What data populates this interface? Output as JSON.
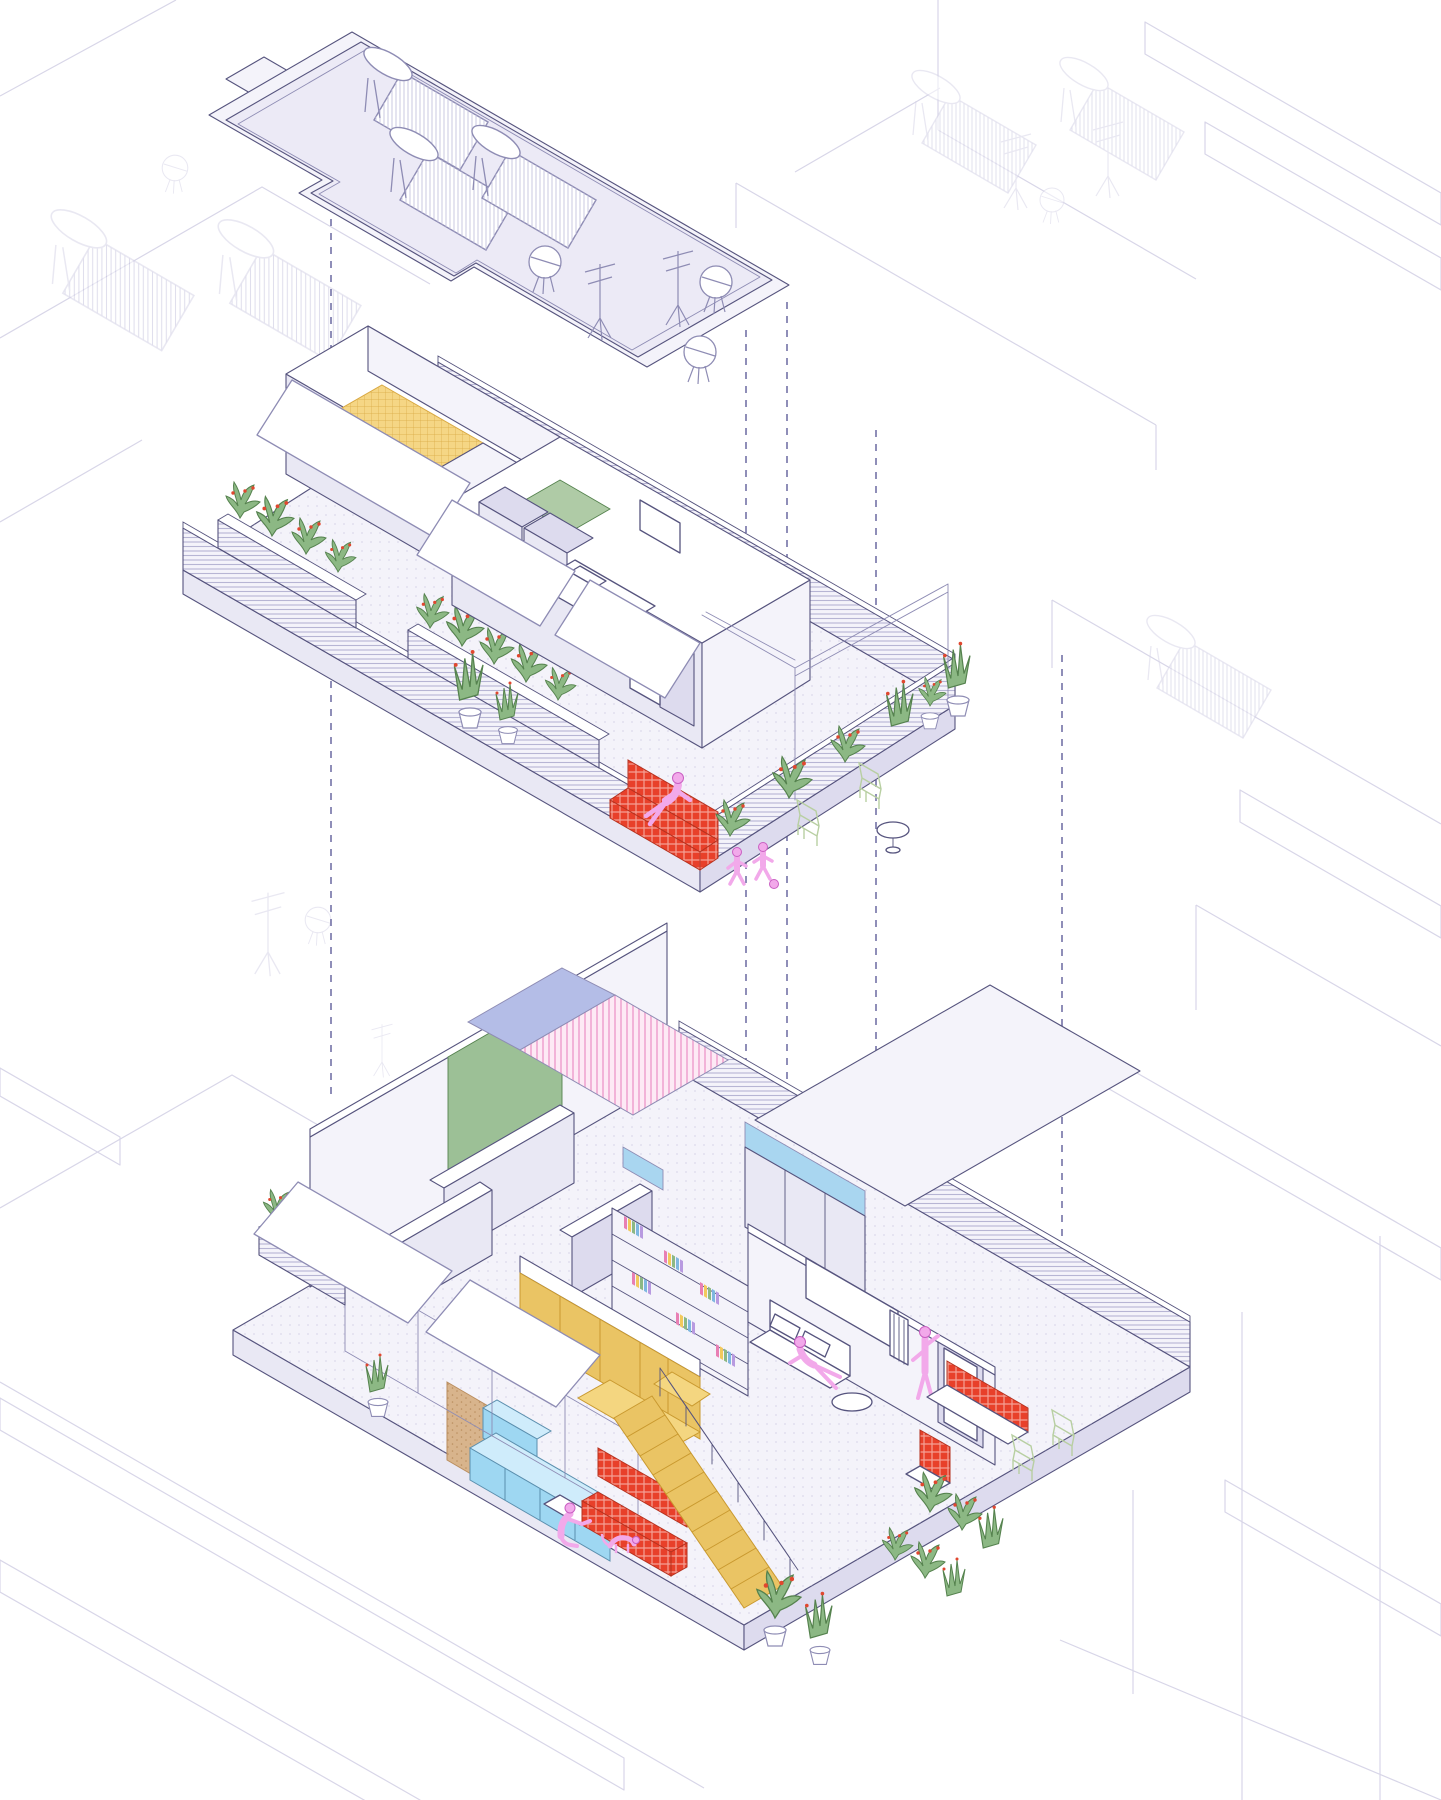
{
  "drawing": {
    "kind": "axonometric-exploded-diagram",
    "subject": "duplex apartment: roof plan, upper floor and lower floor pulled apart vertically",
    "levels": [
      {
        "name": "roof-plan",
        "elements": [
          "parapet",
          "solar-water-heaters",
          "satellite-dishes",
          "tv-antennas"
        ]
      },
      {
        "name": "upper-floor",
        "elements": [
          "yellow-tiled-bathroom",
          "yellow-door",
          "green-bathroom-floor",
          "bedroom",
          "bed",
          "wardrobes",
          "tv-panel",
          "terrace",
          "striped-parapet",
          "planter-boxes",
          "potted-plants",
          "awnings",
          "pergola",
          "red-plaid-bench",
          "adult-reclining-on-bench",
          "two-children-playing",
          "pink-ball",
          "wire-chairs",
          "round-table",
          "railing"
        ]
      },
      {
        "name": "lower-floor",
        "elements": [
          "green-wall",
          "pink-striped-ceiling",
          "lavender-blue-wall",
          "blue-accent-bands",
          "bookshelf-with-colorful-books",
          "yellow-wardrobe",
          "yellow-floor",
          "brick-wall",
          "kitchen-blue-cabinets",
          "extractor-hood",
          "sink",
          "red-plaid-bench",
          "crouching-person",
          "cat",
          "yellow-staircase",
          "stair-railing",
          "living-room",
          "window",
          "radiator",
          "white-sofa",
          "adult-on-sofa",
          "adult-at-sliding-door",
          "sliding-door",
          "coffee-table",
          "terrace",
          "red-plaid-outdoor-sofa",
          "wire-chairs",
          "striped-parapet",
          "planters",
          "potted-plants",
          "awnings",
          "glazing-mullions"
        ]
      }
    ],
    "background": [
      "neighbor-rooftops",
      "faint-solar-water-heaters",
      "faint-satellite-dishes",
      "faint-tv-antennas",
      "faint-balcony-railings",
      "faint-building-edges"
    ],
    "projection": {
      "dashed_guide_lines": 5
    }
  },
  "palette": {
    "line": "#56547E",
    "mid": "#8E8CB4",
    "faint": "#D8D6E8",
    "dash": "#6A68A0",
    "white": "#FFFFFF",
    "lav1": "#F4F3FA",
    "lav2": "#E9E8F4",
    "lav3": "#DDDBEE",
    "floorlav": "#ECEAF6",
    "dot": "#C7C5DF",
    "rail": "#B7B5D4",
    "tile": "#F5D685",
    "tileline": "#D9A943",
    "mustard": "#EAC464",
    "mustardline": "#C9992F",
    "mustardlight": "#F4D680",
    "green": "#9CC096",
    "greenlight": "#AFCBA6",
    "blue": "#A9D6F0",
    "kblue": "#9ED7F2",
    "kbluetop": "#CFECFB",
    "kline": "#5B8FAE",
    "pinkbg": "#FDEAF5",
    "pinkstripe": "#F2B3D8",
    "lavblue": "#B4BDE7",
    "red": "#E8402A",
    "redline": "#B5321F",
    "brick": "#D8B48C",
    "brickdot": "#BA8E5F",
    "plant": "#8CB884",
    "plantdark": "#55824E",
    "flower": "#E0472F",
    "sage": "#B8CFA2",
    "fig": "#F2A9EA",
    "figline": "#C95FC2"
  }
}
